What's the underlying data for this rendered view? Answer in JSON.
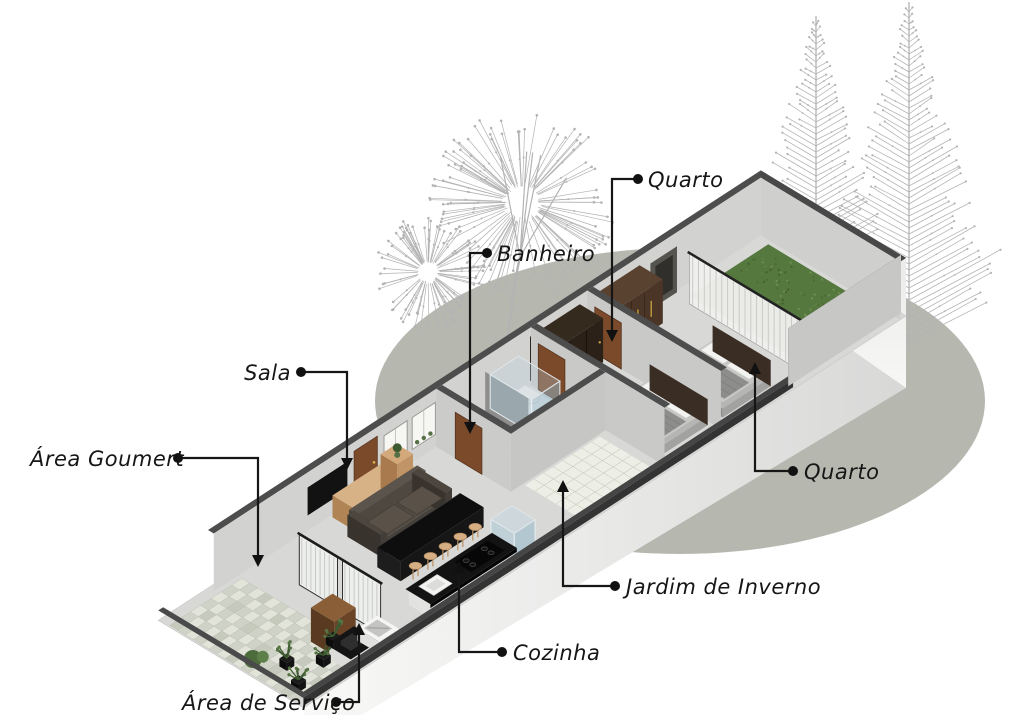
{
  "labels": [
    {
      "id": "quarto-1",
      "text": "Quarto",
      "room": "bedroom-1"
    },
    {
      "id": "banheiro",
      "text": "Banheiro",
      "room": "bathroom"
    },
    {
      "id": "sala",
      "text": "Sala",
      "room": "living-room"
    },
    {
      "id": "area-goumert",
      "text": "Área Goumert",
      "room": "gourmet-area"
    },
    {
      "id": "quarto-2",
      "text": "Quarto",
      "room": "bedroom-2"
    },
    {
      "id": "jardim-de-inverno",
      "text": "Jardim de Inverno",
      "room": "winter-garden"
    },
    {
      "id": "cozinha",
      "text": "Cozinha",
      "room": "kitchen"
    },
    {
      "id": "area-de-servico",
      "text": "Área de Serviço",
      "room": "service-area"
    }
  ],
  "palette": {
    "ink": "#161616",
    "ground_ellipse": "#b6b8b0",
    "tree_sketch": "#b3b3b3",
    "wall_band": "#4d4d4d",
    "wall_face": "#d2d2d0",
    "floor": "#d8d8d6",
    "exterior_light": "#f8f8f7",
    "exterior_shade": "#d8d8d7",
    "grass": "#55783f",
    "grass_dark": "#435f2c",
    "grass_light": "#6f9055",
    "paver_a": "#cfd3c7",
    "paver_b": "#e2e4da",
    "plant_green": "#3e5a31",
    "wood_light": "#c49a6a",
    "wood_mid": "#8a5f38",
    "wood_dark": "#6b4427",
    "door_brown": "#7b4a2b",
    "counter_black": "#131313",
    "sofa": "#46413b",
    "curtain": "#f0f0ee",
    "curtain_stripe": "#c9c9c7",
    "glass_blue": "#a8c8d8",
    "bedding": "#c7c7c5",
    "bedding_dark": "#8d8d8b",
    "white_surface": "#f3f3f1",
    "wardrobe_dark": "#2b2118",
    "wardrobe_brown": "#4a3526",
    "gold": "#c9a53f"
  }
}
